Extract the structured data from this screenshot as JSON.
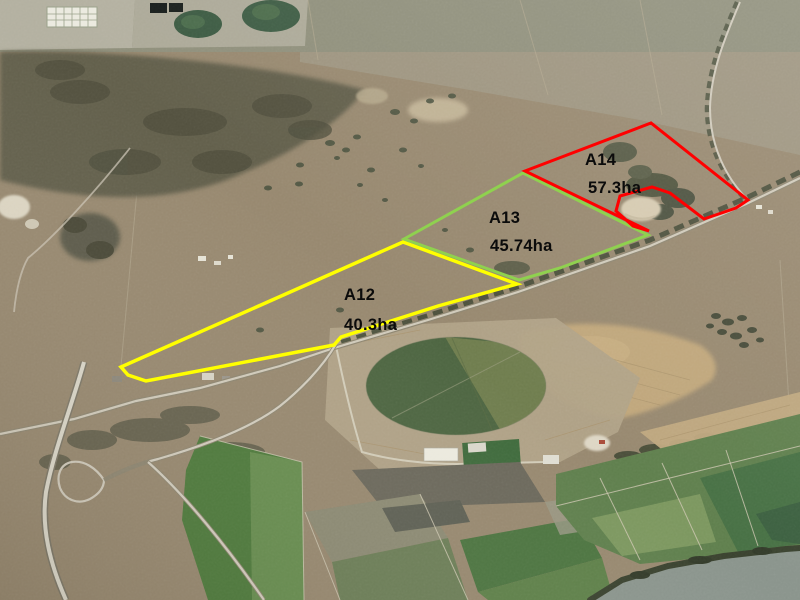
{
  "map": {
    "kind": "aerial-property-parcel-map",
    "label_color": "#0b0b0b",
    "parcels": [
      {
        "id": "A12",
        "area_label": "40.3ha",
        "outline_color": "#ffff00",
        "stroke_width": 3.5,
        "points": "121,367 403,242 517,284 438,306 341,337 334,345 146,381 128,375",
        "id_pos": {
          "x": 344,
          "y": 300
        },
        "area_pos": {
          "x": 344,
          "y": 330
        }
      },
      {
        "id": "A13",
        "area_label": "45.74ha",
        "outline_color": "#8fd14f",
        "stroke_width": 3,
        "points": "404,239 523,173 648,235 560,268 519,280",
        "id_pos": {
          "x": 489,
          "y": 223
        },
        "area_pos": {
          "x": 490,
          "y": 251
        }
      },
      {
        "id": "A14",
        "area_label": "57.3ha",
        "outline_color": "#ff0000",
        "stroke_width": 3,
        "points": "525,171 651,123 748,200 736,208 704,219 670,193 652,187 620,196 616,211 633,226 649,231",
        "id_pos": {
          "x": 585,
          "y": 165
        },
        "area_pos": {
          "x": 588,
          "y": 193
        }
      }
    ]
  }
}
